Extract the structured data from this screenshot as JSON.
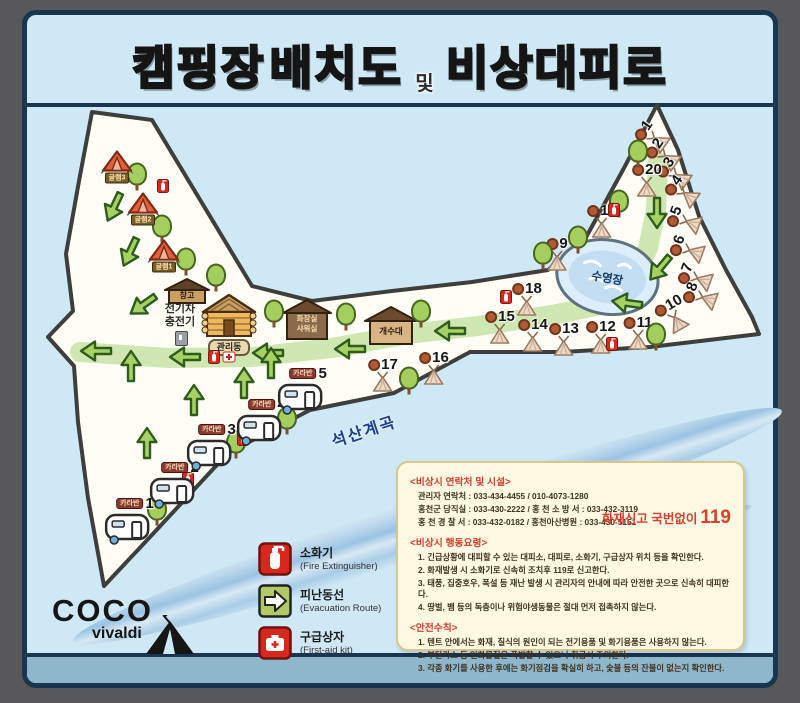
{
  "title": {
    "part1": "캠핑장",
    "part2": "배치도",
    "part3": "및",
    "part4": "비상대피로"
  },
  "map": {
    "pool_label": "수영장",
    "river_label": "석산계곡",
    "buildings": {
      "storage": "창고",
      "office": "관리동",
      "restroom_line1": "화장실",
      "restroom_line2": "샤워실",
      "sink": "개수대",
      "ev_line1": "전기차",
      "ev_line2": "충전기"
    },
    "sites": [
      {
        "n": "1",
        "x": 651,
        "y": 136,
        "rot": -55
      },
      {
        "n": "2",
        "x": 662,
        "y": 154,
        "rot": -55
      },
      {
        "n": "3",
        "x": 673,
        "y": 173,
        "rot": -55
      },
      {
        "n": "4",
        "x": 681,
        "y": 191,
        "rot": -55
      },
      {
        "n": "5",
        "x": 683,
        "y": 220,
        "rot": -70
      },
      {
        "n": "6",
        "x": 686,
        "y": 249,
        "rot": -70
      },
      {
        "n": "7",
        "x": 694,
        "y": 277,
        "rot": -70
      },
      {
        "n": "8",
        "x": 699,
        "y": 296,
        "rot": -70
      },
      {
        "n": "9",
        "x": 557,
        "y": 253,
        "rot": 0
      },
      {
        "n": "10",
        "x": 673,
        "y": 314,
        "rot": -30
      },
      {
        "n": "11",
        "x": 638,
        "y": 332,
        "rot": 0
      },
      {
        "n": "12",
        "x": 601,
        "y": 336,
        "rot": 0
      },
      {
        "n": "13",
        "x": 564,
        "y": 338,
        "rot": 0
      },
      {
        "n": "14",
        "x": 533,
        "y": 334,
        "rot": 0
      },
      {
        "n": "15",
        "x": 500,
        "y": 326,
        "rot": 0
      },
      {
        "n": "16",
        "x": 434,
        "y": 367,
        "rot": 0
      },
      {
        "n": "17",
        "x": 383,
        "y": 374,
        "rot": 0
      },
      {
        "n": "18",
        "x": 527,
        "y": 298,
        "rot": 0
      },
      {
        "n": "19",
        "x": 602,
        "y": 220,
        "rot": 0
      },
      {
        "n": "20",
        "x": 647,
        "y": 179,
        "rot": 0
      }
    ],
    "trees": [
      {
        "x": 137,
        "y": 174
      },
      {
        "x": 162,
        "y": 226
      },
      {
        "x": 186,
        "y": 259
      },
      {
        "x": 216,
        "y": 275
      },
      {
        "x": 274,
        "y": 311
      },
      {
        "x": 346,
        "y": 314
      },
      {
        "x": 421,
        "y": 311
      },
      {
        "x": 409,
        "y": 378
      },
      {
        "x": 638,
        "y": 151
      },
      {
        "x": 619,
        "y": 201
      },
      {
        "x": 578,
        "y": 237
      },
      {
        "x": 656,
        "y": 334
      },
      {
        "x": 157,
        "y": 509
      },
      {
        "x": 236,
        "y": 442
      },
      {
        "x": 287,
        "y": 418
      },
      {
        "x": 543,
        "y": 253
      }
    ],
    "arrows": [
      {
        "x": 114,
        "y": 207,
        "rot": 115
      },
      {
        "x": 130,
        "y": 252,
        "rot": 115
      },
      {
        "x": 143,
        "y": 305,
        "rot": 145
      },
      {
        "x": 96,
        "y": 351,
        "rot": 180
      },
      {
        "x": 185,
        "y": 357,
        "rot": 180
      },
      {
        "x": 268,
        "y": 353,
        "rot": 180
      },
      {
        "x": 350,
        "y": 349,
        "rot": 180
      },
      {
        "x": 450,
        "y": 331,
        "rot": 180
      },
      {
        "x": 627,
        "y": 303,
        "rot": 188
      },
      {
        "x": 660,
        "y": 268,
        "rot": 130
      },
      {
        "x": 657,
        "y": 213,
        "rot": 90
      },
      {
        "x": 131,
        "y": 366,
        "rot": 270
      },
      {
        "x": 194,
        "y": 400,
        "rot": 270
      },
      {
        "x": 244,
        "y": 383,
        "rot": 270
      },
      {
        "x": 147,
        "y": 443,
        "rot": 270
      },
      {
        "x": 271,
        "y": 363,
        "rot": 270
      }
    ],
    "fire_extinguishers": [
      {
        "x": 163,
        "y": 186
      },
      {
        "x": 214,
        "y": 357
      },
      {
        "x": 188,
        "y": 479
      },
      {
        "x": 243,
        "y": 439
      },
      {
        "x": 612,
        "y": 344
      },
      {
        "x": 506,
        "y": 297
      },
      {
        "x": 614,
        "y": 210
      }
    ],
    "first_aid_kits": [
      {
        "x": 229,
        "y": 357
      }
    ],
    "caravans": [
      {
        "n": "1",
        "label": "카라반",
        "x": 127,
        "y": 520
      },
      {
        "n": "2",
        "label": "카라반",
        "x": 172,
        "y": 484
      },
      {
        "n": "3",
        "label": "카라반",
        "x": 209,
        "y": 446
      },
      {
        "n": "4",
        "label": "카라반",
        "x": 259,
        "y": 421
      },
      {
        "n": "5",
        "label": "카라반",
        "x": 300,
        "y": 390
      }
    ],
    "glamping": [
      {
        "label": "글램3",
        "x": 117,
        "y": 166
      },
      {
        "label": "글램2",
        "x": 143,
        "y": 208
      },
      {
        "label": "글램1",
        "x": 164,
        "y": 255
      }
    ]
  },
  "legend": {
    "items": [
      {
        "ko": "소화기",
        "en": "(Fire Extinguisher)"
      },
      {
        "ko": "피난동선",
        "en": "(Evacuation Route)"
      },
      {
        "ko": "구급상자",
        "en": "(First-aid kit)"
      }
    ]
  },
  "info_box": {
    "contact_title": "<비상시 연락처 및 시설>",
    "contacts": [
      "관리자 연락처 : 033-434-4455 / 010-4073-1280",
      "홍천군 당직실 : 033-430-2222 / 홍 천 소 방 서 : 033-432-3119",
      "홍 천 경 찰 서 : 033-432-0182 / 홍천아산병원 : 033-430-5151"
    ],
    "fire_call_label": "화재신고 국번없이",
    "fire_call_number": "119",
    "action_title": "<비상시 행동요령>",
    "actions": [
      "1. 긴급상황에 대피할 수 있는 대피소, 대피로, 소화기, 구급상자 위치 등을 확인한다.",
      "2. 화재발생 시 소화기로 신속히 조치후 119로 신고한다.",
      "3. 태풍, 집중호우, 폭설 등 재난 발생 시 관리자의 안내에 따라 안전한 곳으로 신속히 대피한다.",
      "4. 땅벌, 뱀 등의 독충이나 위험야생동물은 절대 먼저 접촉하지 않는다."
    ],
    "safety_title": "<안전수칙>",
    "safety": [
      "1. 텐트 안에서는 화재, 질식의 원인이 되는 전기용품 및 화기용품은 사용하지 않는다.",
      "2. 부탄가스 등 인화물질은 폭발할 수 있으니 취급시 주의한다.",
      "3. 각종 화기를 사용한 후에는 화기점검을 확실히 하고, 숯불 등의 잔불이 없는지 확인한다."
    ]
  },
  "logo": {
    "line1": "COCO",
    "line2": "vivaldi"
  },
  "colors": {
    "panel_bg": "#cfe8f5",
    "frame": "#1a3550",
    "land": "#fffef6",
    "trail": "#cfe7b2",
    "arrow": "#a6d164",
    "accent_red": "#d6402c",
    "title_yellow": "#f5c84c",
    "title_blue": "#4ba4d9",
    "title_red": "#e05a54"
  }
}
